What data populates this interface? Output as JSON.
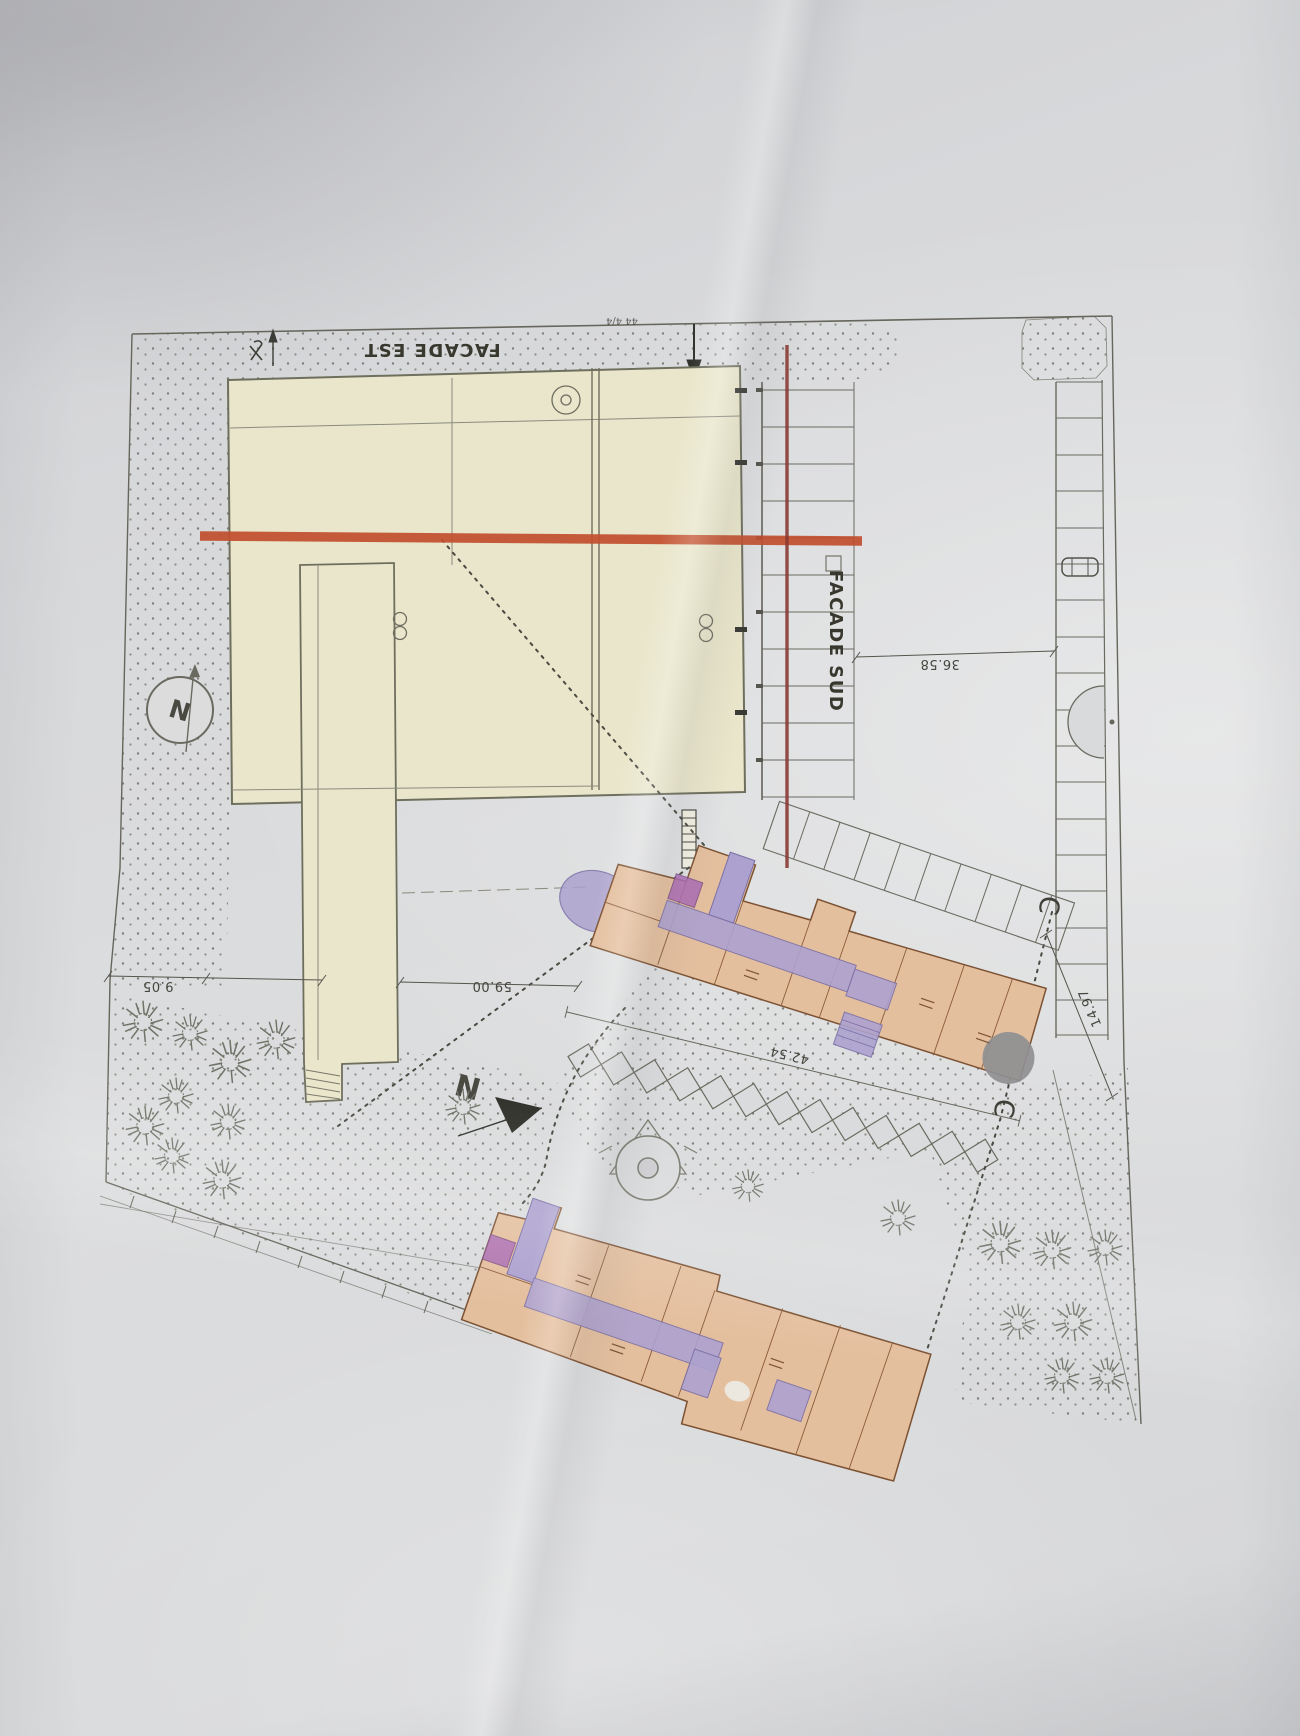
{
  "plan": {
    "labels": {
      "facade_est": "FACADE EST",
      "facade_sud": "FACADE SUD",
      "north_compass": "N",
      "north_arrow": "N",
      "section_marker_top": "C",
      "section_marker_bottom": "C",
      "survey_mark": "x"
    },
    "dimensions": {
      "top_handwritten": "44 4/4",
      "left_offset": "9.05",
      "building_length": "59.00",
      "east_gap": "36.58",
      "diagonal_parking": "42.54",
      "new_block_depth": "14.97"
    },
    "colors": {
      "paper": "#d8d9db",
      "existing_building": "#e9e6cb",
      "new_buildings": "#e4bf9e",
      "circulation_purple": "#ada2cf",
      "highlight_red": "#c14e2e",
      "section_line_maroon": "#8a3a33",
      "ink": "#66665c"
    }
  }
}
